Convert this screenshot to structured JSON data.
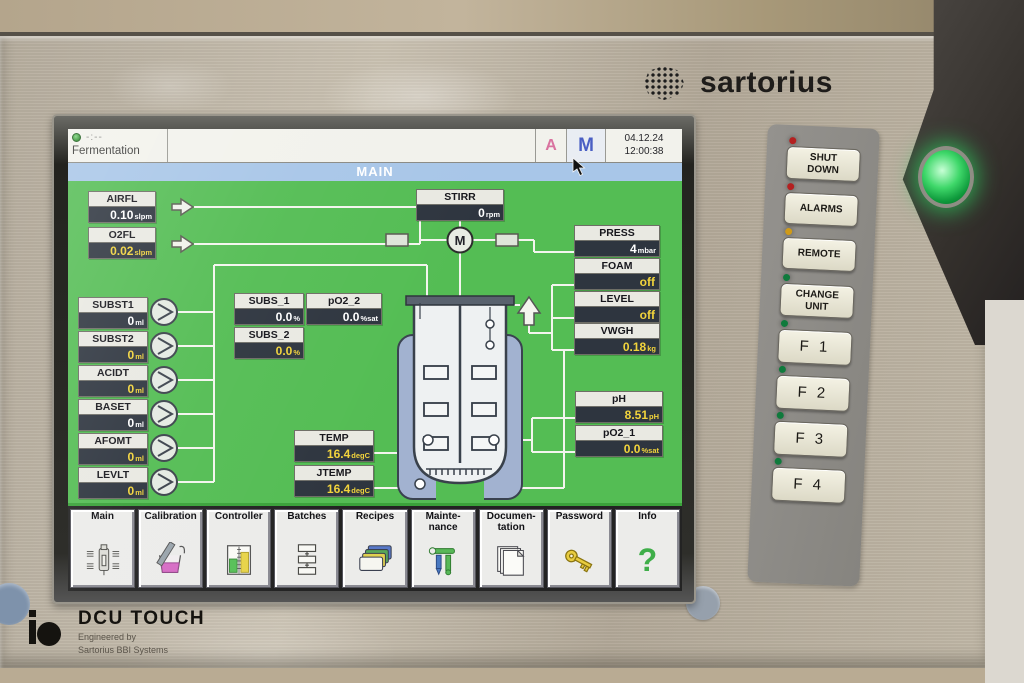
{
  "branding": {
    "logo": "sartorius",
    "device": "DCU TOUCH",
    "engineered_by": "Engineered by",
    "engineered_company": "Sartorius BBI Systems"
  },
  "colors": {
    "screen_bg": "#54bd54",
    "title_bar": "#a8c6e8",
    "value_yellow": "#f2d43c",
    "value_white": "#ffffff",
    "mode_a": "#d9739f",
    "mode_m": "#4a5fc4"
  },
  "screen": {
    "header": {
      "process": "Fermentation",
      "timer": "-:--",
      "auto": "A",
      "manual": "M",
      "date": "04.12.24",
      "time": "12:00:38"
    },
    "title": "MAIN",
    "motor_label": "M",
    "params": {
      "airfl": {
        "label": "AIRFL",
        "value": "0.10",
        "unit": "slpm",
        "value_color": "#ffffff"
      },
      "o2fl": {
        "label": "O2FL",
        "value": "0.02",
        "unit": "slpm",
        "value_color": "#f2d43c"
      },
      "subst1": {
        "label": "SUBST1",
        "value": "0",
        "unit": "ml",
        "value_color": "#ffffff"
      },
      "subst2": {
        "label": "SUBST2",
        "value": "0",
        "unit": "ml",
        "value_color": "#f2d43c"
      },
      "acidt": {
        "label": "ACIDT",
        "value": "0",
        "unit": "ml",
        "value_color": "#f2d43c"
      },
      "baset": {
        "label": "BASET",
        "value": "0",
        "unit": "ml",
        "value_color": "#ffffff"
      },
      "afomt": {
        "label": "AFOMT",
        "value": "0",
        "unit": "ml",
        "value_color": "#f2d43c"
      },
      "levlt": {
        "label": "LEVLT",
        "value": "0",
        "unit": "ml",
        "value_color": "#f2d43c"
      },
      "subs1": {
        "label": "SUBS_1",
        "value": "0.0",
        "unit": "%",
        "value_color": "#ffffff"
      },
      "po2_2": {
        "label": "pO2_2",
        "value": "0.0",
        "unit": "%sat",
        "value_color": "#ffffff"
      },
      "subs2": {
        "label": "SUBS_2",
        "value": "0.0",
        "unit": "%",
        "value_color": "#f2d43c"
      },
      "stirr": {
        "label": "STIRR",
        "value": "0",
        "unit": "rpm",
        "value_color": "#ffffff"
      },
      "press": {
        "label": "PRESS",
        "value": "4",
        "unit": "mbar",
        "value_color": "#ffffff"
      },
      "foam": {
        "label": "FOAM",
        "value": "off",
        "unit": "",
        "value_color": "#f2d43c"
      },
      "level": {
        "label": "LEVEL",
        "value": "off",
        "unit": "",
        "value_color": "#f2d43c"
      },
      "vwgh": {
        "label": "VWGH",
        "value": "0.18",
        "unit": "kg",
        "value_color": "#f2d43c"
      },
      "ph": {
        "label": "pH",
        "value": "8.51",
        "unit": "pH",
        "value_color": "#f2d43c"
      },
      "po2_1": {
        "label": "pO2_1",
        "value": "0.0",
        "unit": "%sat",
        "value_color": "#f2d43c"
      },
      "temp": {
        "label": "TEMP",
        "value": "16.4",
        "unit": "degC",
        "value_color": "#f2d43c"
      },
      "jtemp": {
        "label": "JTEMP",
        "value": "16.4",
        "unit": "degC",
        "value_color": "#f2d43c"
      }
    },
    "menu": [
      {
        "label": "Main"
      },
      {
        "label": "Calibration"
      },
      {
        "label": "Controller"
      },
      {
        "label": "Batches"
      },
      {
        "label": "Recipes"
      },
      {
        "label": "Mainte-\nnance"
      },
      {
        "label": "Documen-\ntation"
      },
      {
        "label": "Password"
      },
      {
        "label": "Info",
        "glyph": "?"
      }
    ]
  },
  "keypad": {
    "buttons": [
      {
        "label": "SHUT\nDOWN",
        "led": "#b42020"
      },
      {
        "label": "ALARMS",
        "led": "#b42020"
      },
      {
        "label": "REMOTE",
        "led": "#cf9a18"
      },
      {
        "label": "CHANGE\nUNIT",
        "led": "#0f7a3c"
      },
      {
        "label": "F 1",
        "led": "#0f7a3c"
      },
      {
        "label": "F 2",
        "led": "#0f7a3c"
      },
      {
        "label": "F 3",
        "led": "#0f7a3c"
      },
      {
        "label": "F 4",
        "led": "#0f7a3c"
      }
    ]
  }
}
